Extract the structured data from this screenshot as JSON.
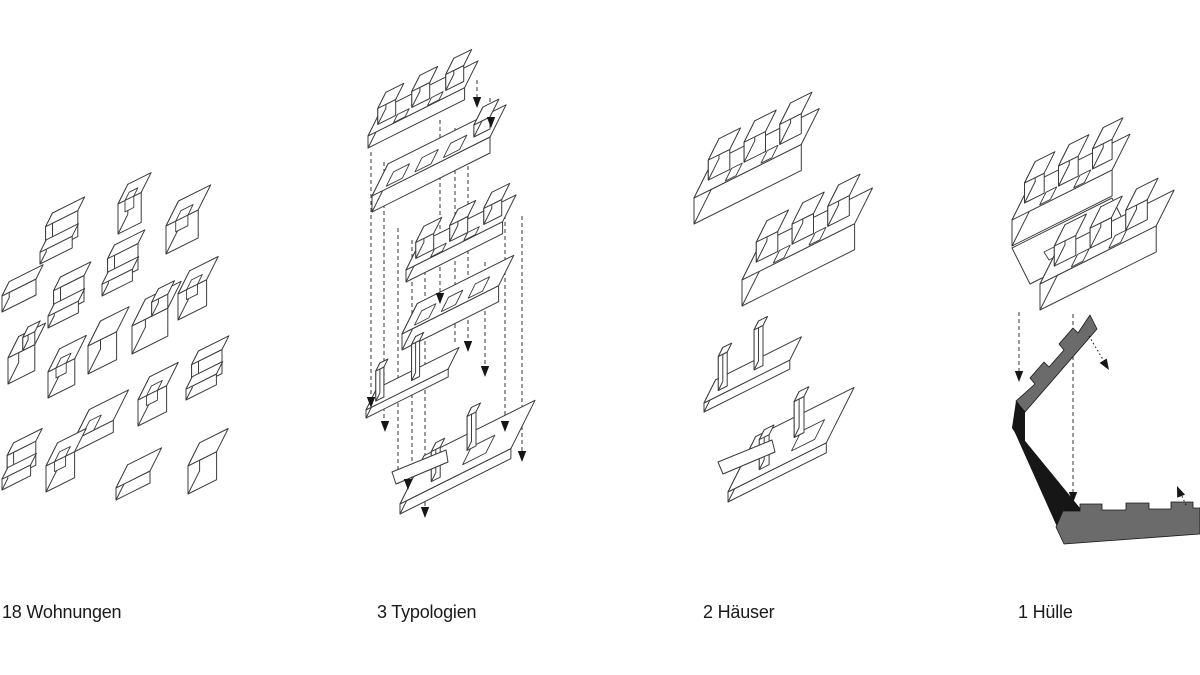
{
  "colors": {
    "background": "#ffffff",
    "line": "#3c3c3c",
    "dash": "#4a4a4a",
    "arrow": "#161616",
    "shell_gray": "#6b6b6b",
    "shell_dark": "#161616",
    "label_text": "#1a1a1a"
  },
  "panels": [
    {
      "label": "18 Wohnungen",
      "diagram": "scattered-apartment-unit-blocks"
    },
    {
      "label": "3 Typologien",
      "diagram": "exploded-axonometric-typology-stack"
    },
    {
      "label": "2 Häuser",
      "diagram": "two-house-volumes-with-ground-plates"
    },
    {
      "label": "1 Hülle",
      "diagram": "unfolded-grey-envelope-shell"
    }
  ]
}
